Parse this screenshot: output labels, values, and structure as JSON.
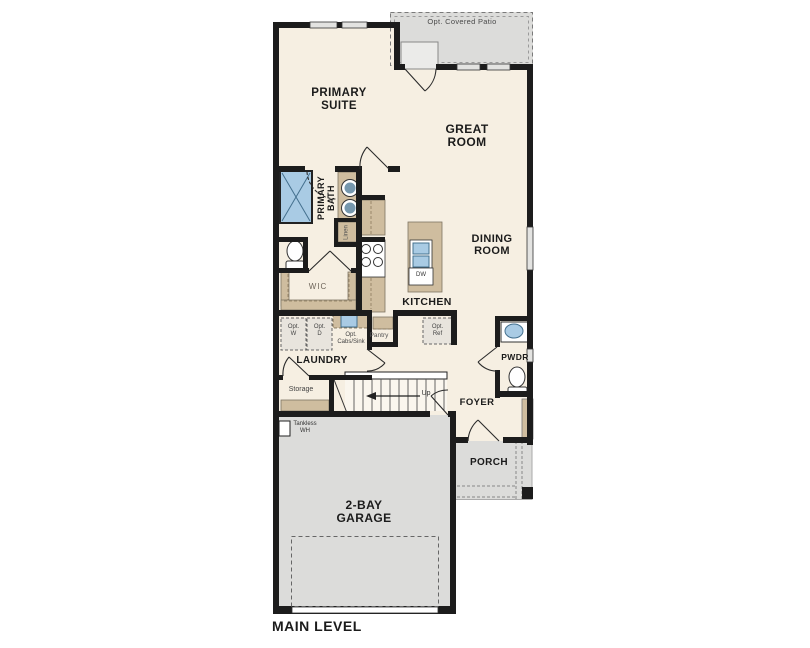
{
  "plan": {
    "title": "MAIN LEVEL",
    "rooms": {
      "patio": "Opt. Covered Patio",
      "primary_suite": "PRIMARY\nSUITE",
      "great_room": "GREAT\nROOM",
      "dining_room": "DINING\nROOM",
      "kitchen": "KITCHEN",
      "primary_bath": "PRIMARY\nBATH",
      "wic": "WIC",
      "laundry": "LAUNDRY",
      "pantry": "Pantry",
      "storage": "Storage",
      "pwdr": "PWDR",
      "foyer": "FOYER",
      "porch": "PORCH",
      "garage": "2-BAY\nGARAGE"
    },
    "fixtures": {
      "linen": "Linen",
      "dishwasher": "DW",
      "stairs_up": "Up",
      "opt_washer": "Opt.\nW",
      "opt_dryer": "Opt.\nD",
      "opt_cabs_sink": "Opt.\nCabs/Sink",
      "opt_ref": "Opt.\nRef",
      "tankless_wh": "Tankless\nWH"
    },
    "colors": {
      "wall": "#1c1c1c",
      "floor": "#f6efe2",
      "slab": "#dcdcda",
      "cabinet": "#cfbd9f",
      "fixture_blue": "#a9cbe4"
    }
  }
}
